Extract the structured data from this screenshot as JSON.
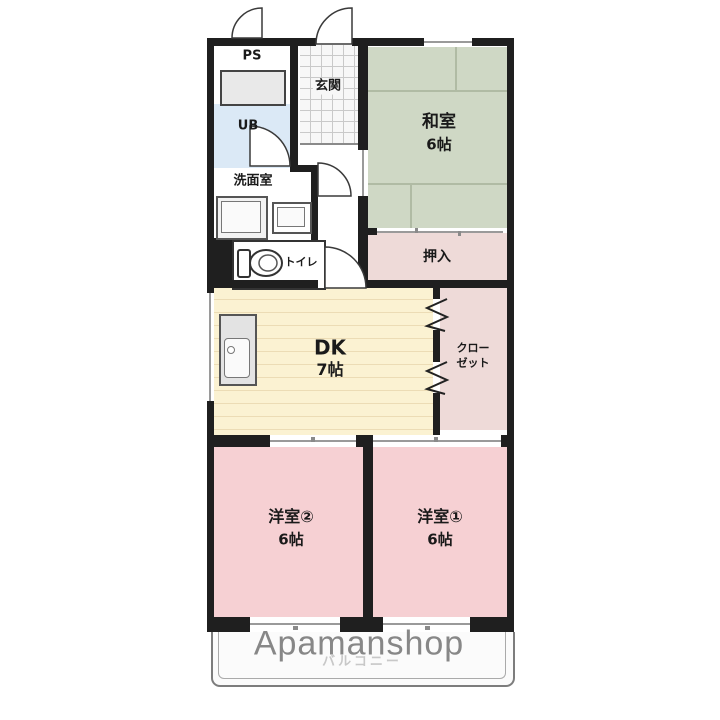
{
  "meta": {
    "type": "floor-plan",
    "branding": {
      "watermark": "Apamanshop"
    }
  },
  "rooms": {
    "ps": {
      "label": "PS"
    },
    "ub": {
      "label": "UB"
    },
    "washroom": {
      "label": "洗面室"
    },
    "toilet": {
      "label": "トイレ"
    },
    "entrance": {
      "label": "玄関"
    },
    "japanese_room": {
      "label": "和室",
      "size": "6帖"
    },
    "oshiire": {
      "label": "押入"
    },
    "dk": {
      "label": "DK",
      "size": "7帖"
    },
    "closet": {
      "label_line1": "クロー",
      "label_line2": "ゼット"
    },
    "western_room_2": {
      "label": "洋室②",
      "size": "6帖"
    },
    "western_room_1": {
      "label": "洋室①",
      "size": "6帖"
    },
    "balcony": {
      "label": "バルコニー"
    }
  },
  "colors": {
    "wall": "#1f1f1f",
    "japanese_room_fill": "#cfd8c5",
    "western_room_fill": "#f6d0d3",
    "closet_fill": "#eedad8",
    "dk_fill": "#fbf2d2",
    "unit_bath_fill": "#dbe9f6",
    "watermark_gray": "#878787"
  }
}
